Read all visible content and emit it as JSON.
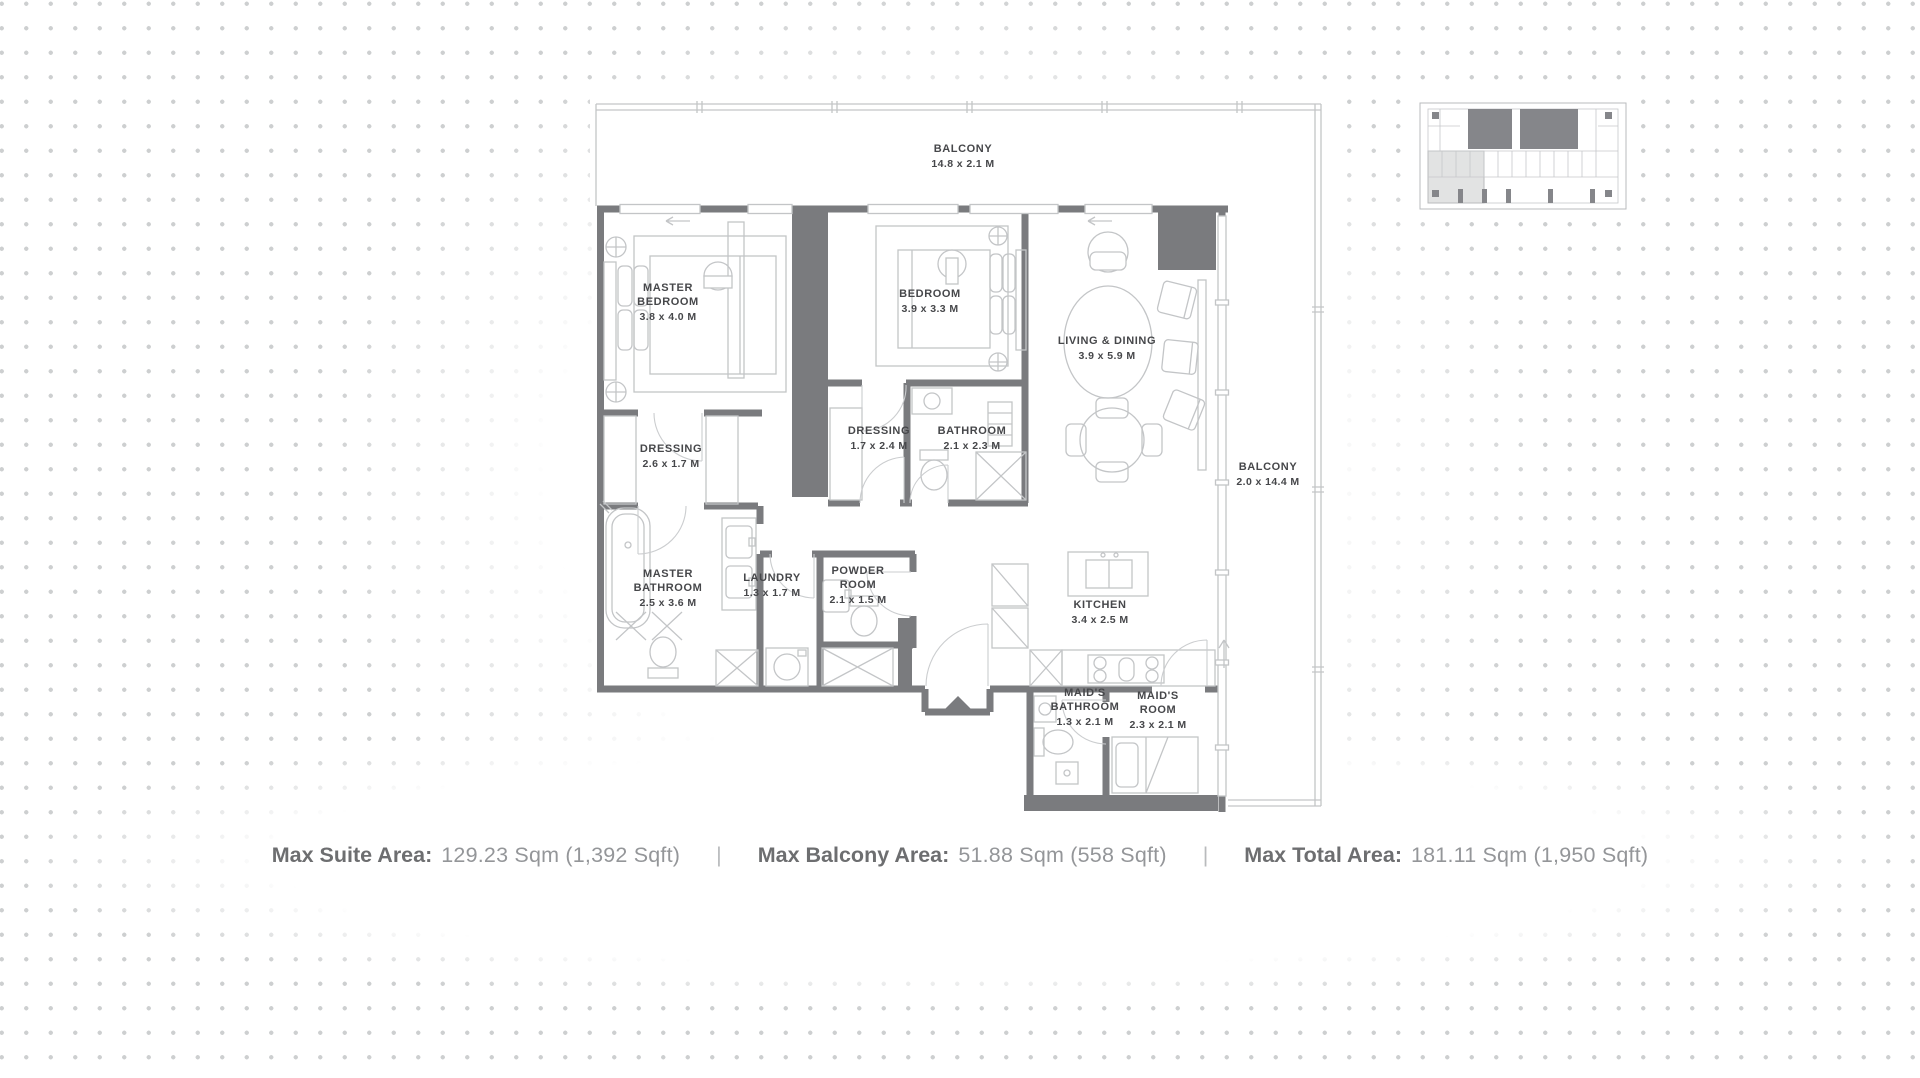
{
  "plan": {
    "rooms": [
      {
        "id": "balcony-top",
        "lines": [
          "BALCONY",
          "14.8 x 2.1 M"
        ]
      },
      {
        "id": "master-bedroom",
        "lines": [
          "MASTER",
          "BEDROOM",
          "3.8 x 4.0 M"
        ]
      },
      {
        "id": "bedroom",
        "lines": [
          "BEDROOM",
          "3.9 x 3.3 M"
        ]
      },
      {
        "id": "living-dining",
        "lines": [
          "LIVING & DINING",
          "3.9 x 5.9 M"
        ]
      },
      {
        "id": "dressing-master",
        "lines": [
          "DRESSING",
          "2.6 x 1.7 M"
        ]
      },
      {
        "id": "dressing-bedroom",
        "lines": [
          "DRESSING",
          "1.7 x 2.4 M"
        ]
      },
      {
        "id": "bathroom",
        "lines": [
          "BATHROOM",
          "2.1 x 2.3 M"
        ]
      },
      {
        "id": "balcony-side",
        "lines": [
          "BALCONY",
          "2.0 x 14.4 M"
        ]
      },
      {
        "id": "master-bathroom",
        "lines": [
          "MASTER",
          "BATHROOM",
          "2.5 x 3.6 M"
        ]
      },
      {
        "id": "laundry",
        "lines": [
          "LAUNDRY",
          "1.3 x 1.7 M"
        ]
      },
      {
        "id": "powder-room",
        "lines": [
          "POWDER",
          "ROOM",
          "2.1 x 1.5 M"
        ]
      },
      {
        "id": "kitchen",
        "lines": [
          "KITCHEN",
          "3.4 x 2.5 M"
        ]
      },
      {
        "id": "maids-bathroom",
        "lines": [
          "MAID'S",
          "BATHROOM",
          "1.3 x 2.1 M"
        ]
      },
      {
        "id": "maids-room",
        "lines": [
          "MAID'S",
          "ROOM",
          "2.3 x 2.1 M"
        ]
      }
    ]
  },
  "footer": {
    "separator": "|",
    "stats": [
      {
        "label": "Max Suite Area:",
        "value": "129.23 Sqm (1,392 Sqft)"
      },
      {
        "label": "Max Balcony Area:",
        "value": "51.88 Sqm (558 Sqft)"
      },
      {
        "label": "Max Total Area:",
        "value": "181.11 Sqm (1,950 Sqft)"
      }
    ]
  },
  "colors": {
    "wall": "#7a7b7e",
    "furniture": "#c3c5c7",
    "room_text": "#46474a",
    "footer_label": "#6d6e70",
    "footer_value": "#949699",
    "dot": "#cdcfd0",
    "keyplan_shade": "#e2e3e3"
  }
}
